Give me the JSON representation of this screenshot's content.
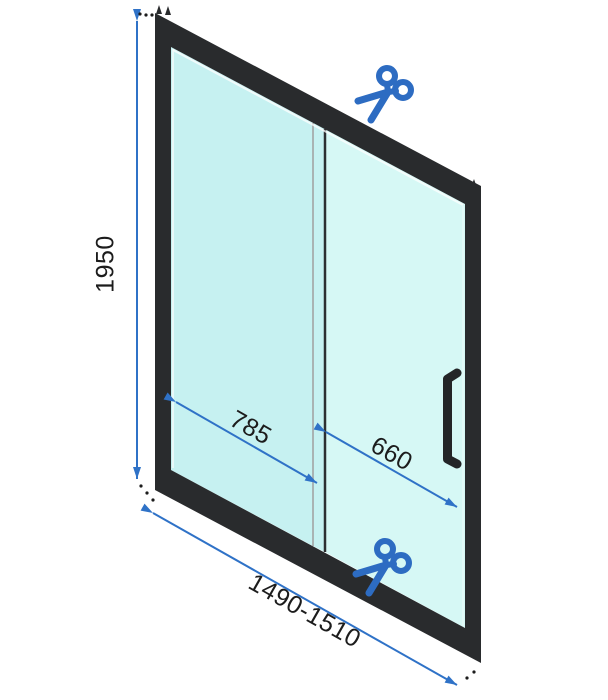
{
  "diagram": {
    "title": "Sliding shower door technical drawing",
    "labels": {
      "height": "1950",
      "sliding_panel_width": "785",
      "fixed_panel_width": "660",
      "total_width_range": "1490-1510"
    },
    "icons": {
      "cut_mark": "scissors"
    },
    "colors": {
      "dimension_blue": "#2f72c7",
      "scissors_blue": "#2d6cc2",
      "frame_black": "#292b2d",
      "handle_black": "#232527",
      "glass_left": "#c6f1f1",
      "glass_right": "#d6f8f5",
      "glass_edge_gray": "#a9b3b3",
      "divider_dark": "#2c2f31",
      "label_text": "#1c1c1c",
      "background": "#ffffff"
    }
  }
}
